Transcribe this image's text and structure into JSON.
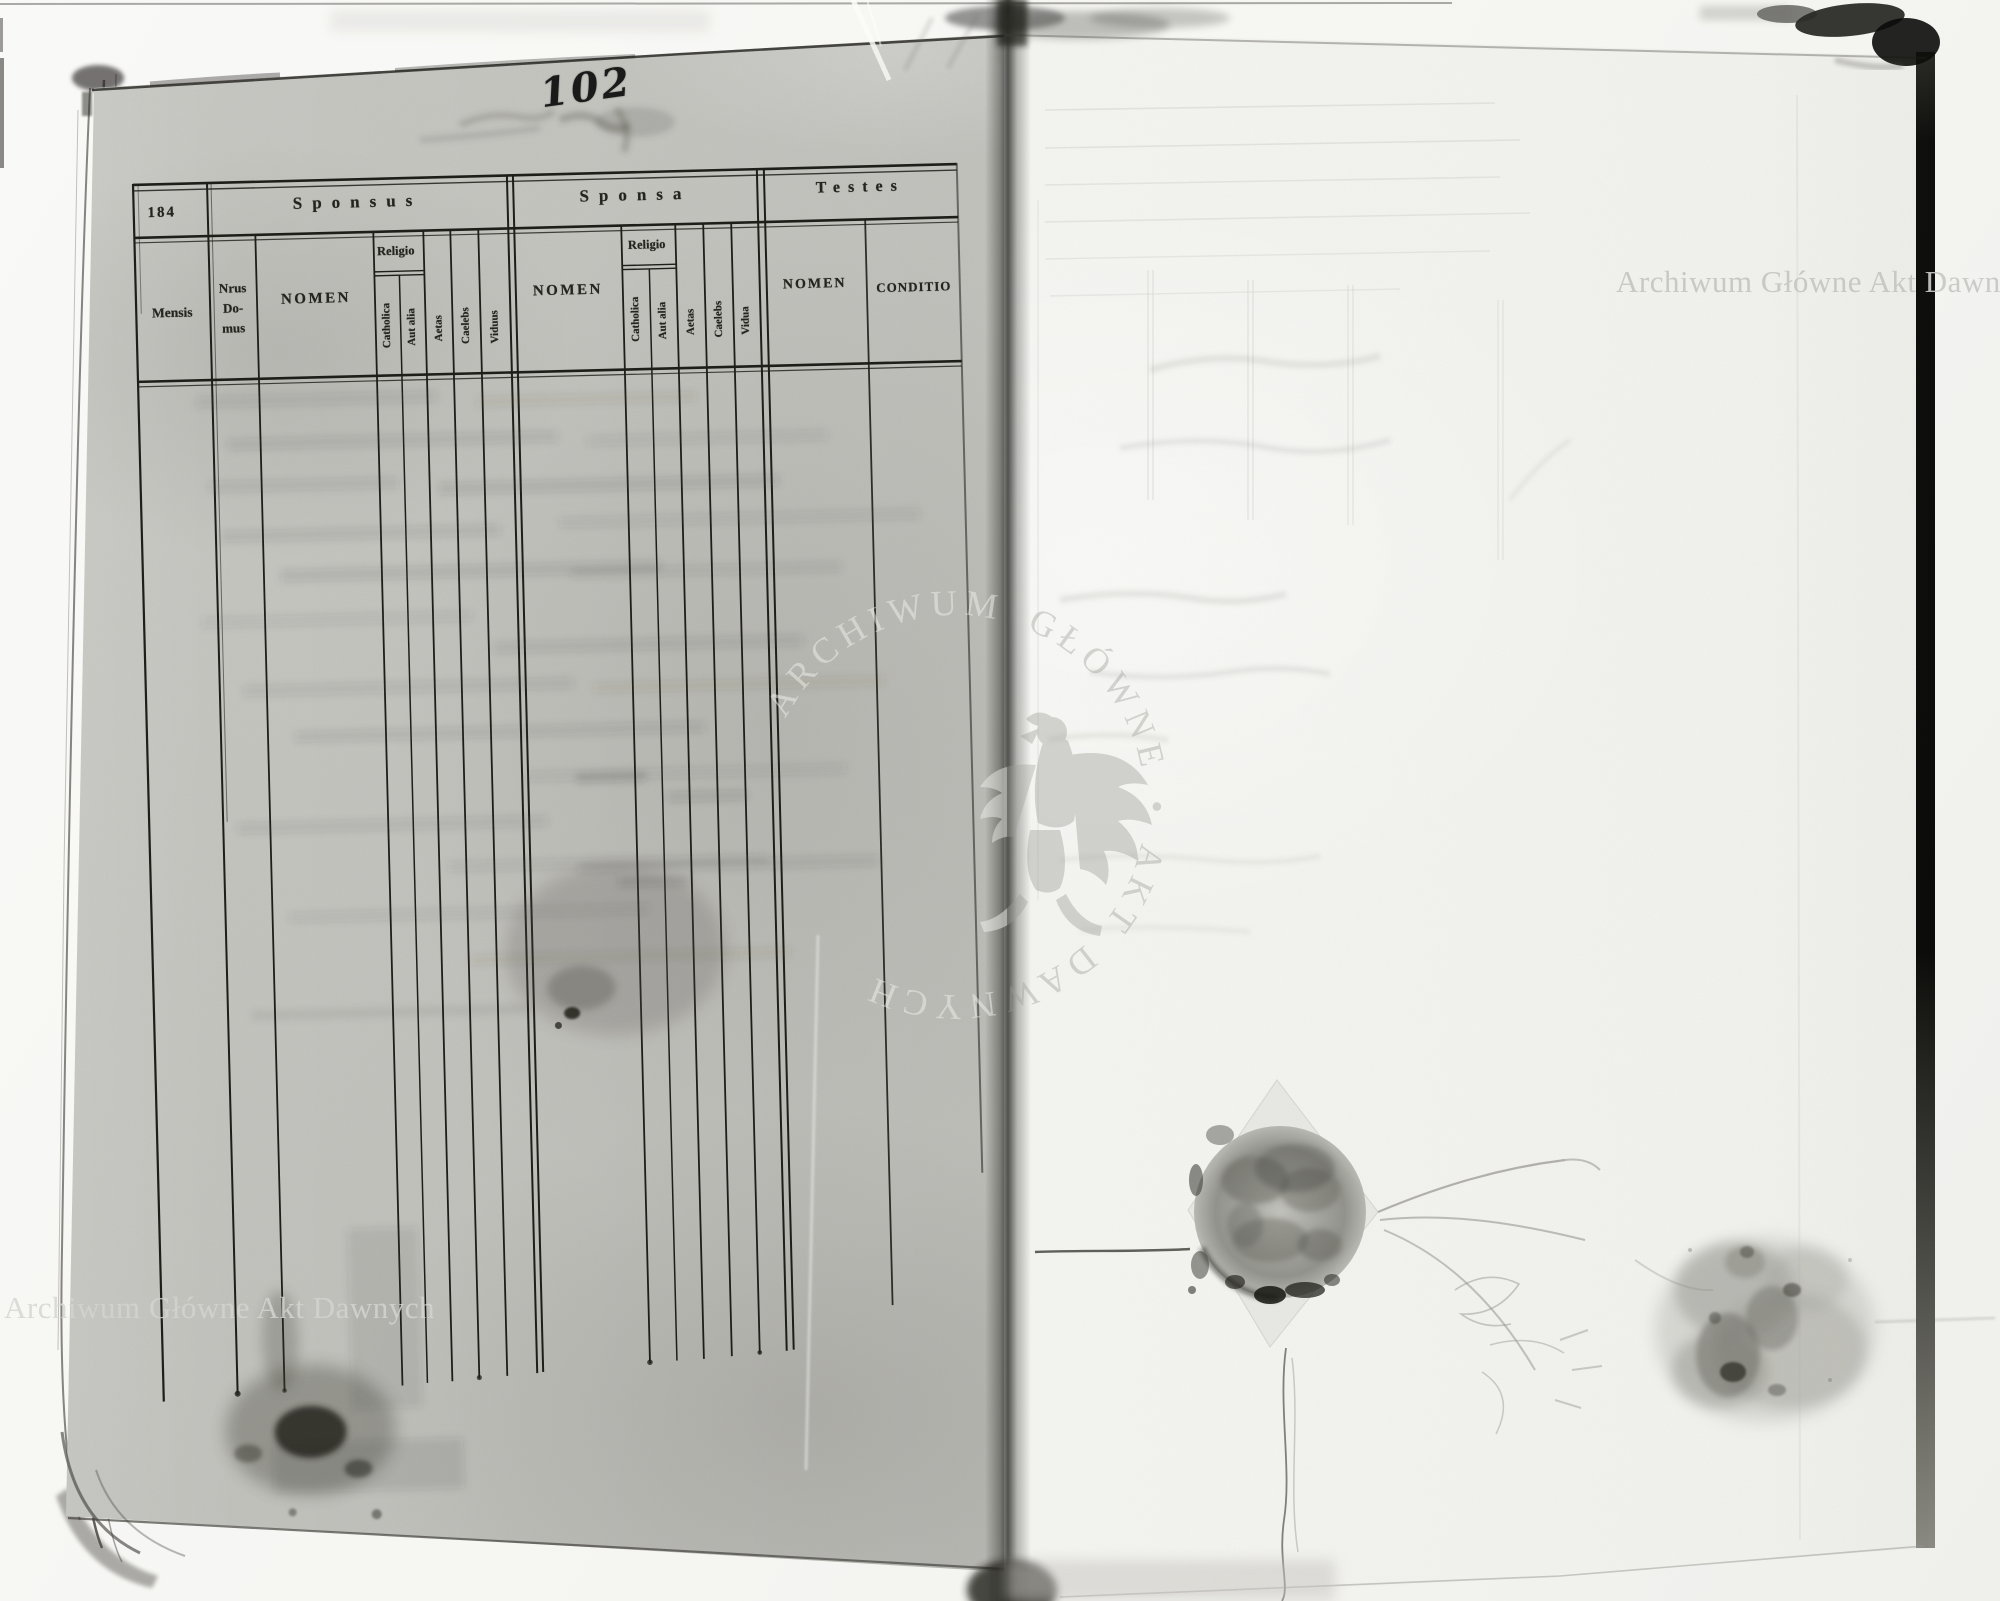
{
  "scan": {
    "handwritten_folio_number": "102",
    "printed_sheet_number": "184",
    "archive_watermark_text": "Archiwum Główne Akt Dawnych",
    "seal_watermark_text": "ARCHIWUM GŁÓWNE • AKT DAWNYCH",
    "colors": {
      "left_page_paper": "#c8c8c3",
      "right_page_paper": "#f2f2ee",
      "printed_ink": "#21211c",
      "watermark_gray": "#c7c7c5"
    }
  },
  "table": {
    "sections": {
      "sponsus": "Sponsus",
      "sponsa": "Sponsa",
      "testes": "Testes"
    },
    "columns": {
      "mensis": "Mensis",
      "nrus_line1": "Nrus",
      "nrus_line2": "Do-",
      "nrus_line3": "mus",
      "nomen": "NOMEN",
      "religio": "Religio",
      "catholica": "Catholica",
      "aut_alia": "Aut alia",
      "aetas": "Aetas",
      "caelebs": "Caelebs",
      "viduus": "Viduus",
      "vidua": "Vidua",
      "conditio": "CONDITIO"
    }
  }
}
